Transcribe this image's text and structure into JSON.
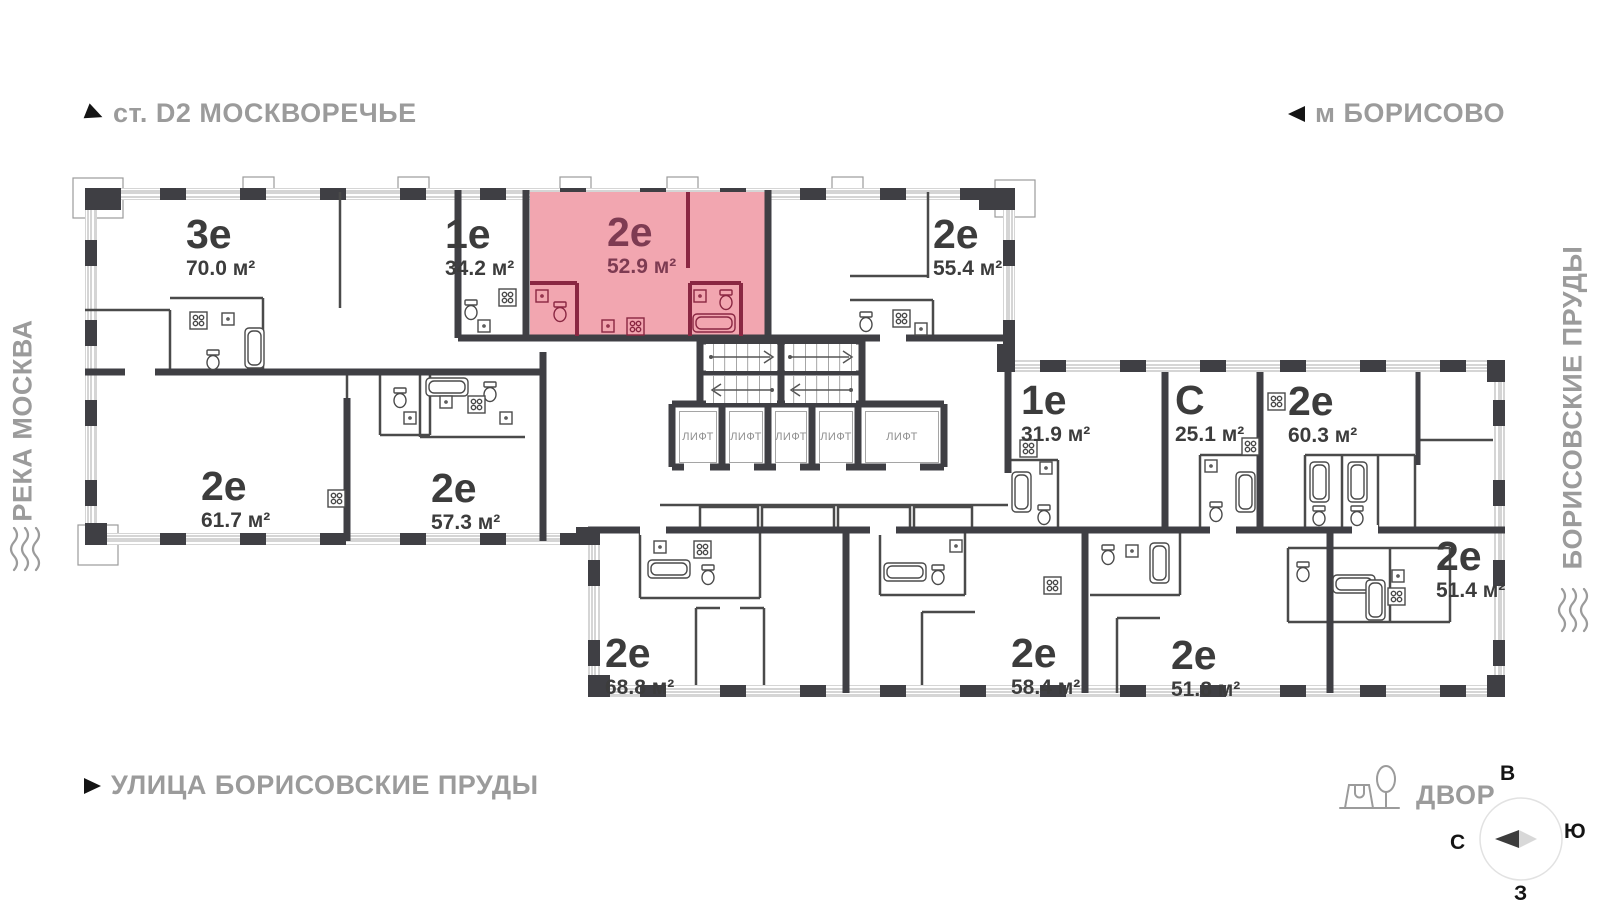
{
  "landmarks": {
    "station": "ст. D2 МОСКВОРЕЧЬЕ",
    "metro": "м БОРИСОВО",
    "river": "РЕКА МОСКВА",
    "ponds": "БОРИСОВСКИЕ ПРУДЫ",
    "street": "УЛИЦА БОРИСОВСКИЕ ПРУДЫ",
    "yard": "ДВОР"
  },
  "compass": {
    "top": "В",
    "right": "Ю",
    "left": "С",
    "bottom": "З"
  },
  "elevators": {
    "label": "ЛИФТ",
    "count": 5
  },
  "units": [
    {
      "type": "3е",
      "area": "70.0 м²",
      "x": 186,
      "y": 214,
      "highlighted": false
    },
    {
      "type": "1е",
      "area": "34.2 м²",
      "x": 445,
      "y": 214,
      "highlighted": false
    },
    {
      "type": "2е",
      "area": "52.9 м²",
      "x": 607,
      "y": 212,
      "highlighted": true
    },
    {
      "type": "2е",
      "area": "55.4 м²",
      "x": 933,
      "y": 214,
      "highlighted": false
    },
    {
      "type": "1е",
      "area": "31.9 м²",
      "x": 1021,
      "y": 380,
      "highlighted": false
    },
    {
      "type": "С",
      "area": "25.1 м²",
      "x": 1175,
      "y": 380,
      "highlighted": false
    },
    {
      "type": "2е",
      "area": "60.3 м²",
      "x": 1288,
      "y": 381,
      "highlighted": false
    },
    {
      "type": "2е",
      "area": "61.7 м²",
      "x": 201,
      "y": 466,
      "highlighted": false
    },
    {
      "type": "2е",
      "area": "57.3 м²",
      "x": 431,
      "y": 468,
      "highlighted": false
    },
    {
      "type": "2е",
      "area": "51.4 м²",
      "x": 1436,
      "y": 536,
      "highlighted": false
    },
    {
      "type": "2е",
      "area": "68.8 м²",
      "x": 605,
      "y": 633,
      "highlighted": false
    },
    {
      "type": "2е",
      "area": "58.4 м²",
      "x": 1011,
      "y": 633,
      "highlighted": false
    },
    {
      "type": "2е",
      "area": "51.8 м²",
      "x": 1171,
      "y": 635,
      "highlighted": false
    }
  ],
  "highlight": {
    "fill": "#F2A6B0",
    "wall": "#8A2742",
    "text": "#7E3B52"
  },
  "colors": {
    "walls": "#3F3F44",
    "labels": "#3C3C3C",
    "landmark_text": "#9B9B9B",
    "arrow": "#141414"
  }
}
